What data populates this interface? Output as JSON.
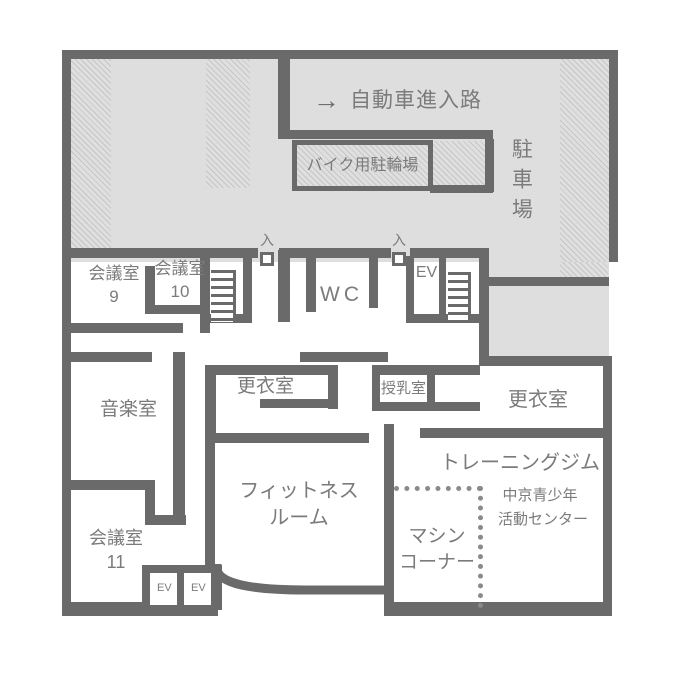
{
  "colors": {
    "wall": "#6a6a6a",
    "text": "#7b7b7b",
    "area_fill": "#dedede",
    "hatch_line": "#c6c6c6",
    "dotted_line": "#8a8a8a",
    "background": "#ffffff"
  },
  "parking": {
    "label": "駐車場",
    "driveway": {
      "arrow": "→",
      "label": "自動車進入路"
    },
    "bike_parking": {
      "label": "バイク用駐輪場"
    }
  },
  "entrance": {
    "label": "入"
  },
  "rooms": {
    "meeting9": {
      "name": "会議室",
      "number": "9"
    },
    "meeting10": {
      "name": "会議室",
      "number": "10"
    },
    "meeting11": {
      "name": "会議室",
      "number": "11"
    },
    "wc": {
      "name": "WC"
    },
    "elevator_upper": {
      "name": "EV"
    },
    "elevator_lower_1": {
      "name": "EV"
    },
    "elevator_lower_2": {
      "name": "EV"
    },
    "music": {
      "name": "音楽室"
    },
    "locker_center": {
      "name": "更衣室"
    },
    "nursing": {
      "name": "授乳室"
    },
    "locker_east": {
      "name": "更衣室"
    },
    "fitness": {
      "name_line1": "フィットネス",
      "name_line2": "ルーム"
    },
    "training_gym": {
      "name": "トレーニングジム",
      "subtitle_line1": "中京青少年",
      "subtitle_line2": "活動センター"
    },
    "machine_corner": {
      "name_line1": "マシン",
      "name_line2": "コーナー"
    }
  }
}
